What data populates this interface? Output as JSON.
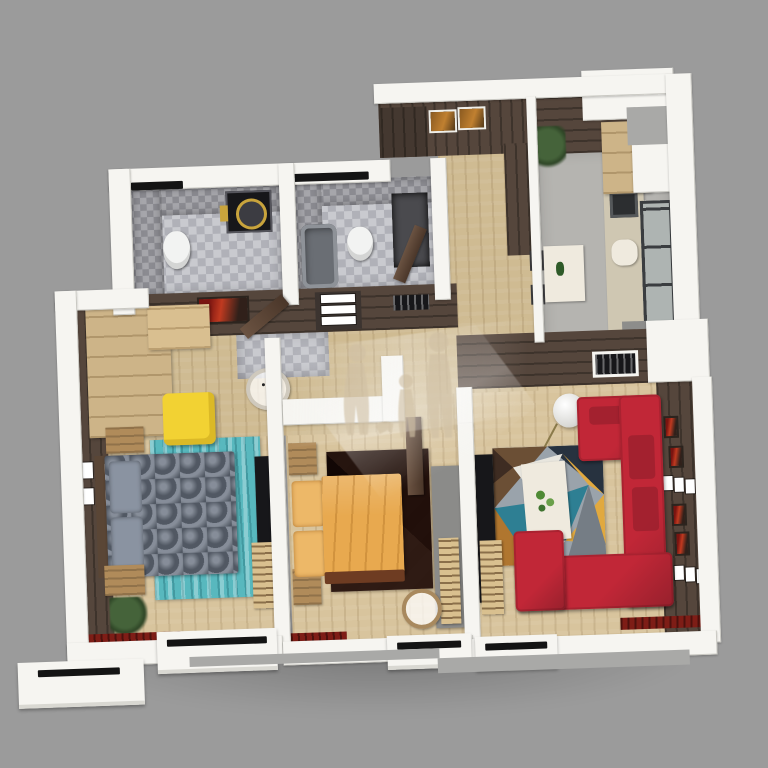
{
  "title": "3d-apartment-floor-plan-render",
  "colors": {
    "bg": "#9b9b9b",
    "wall": "#f6f5f1",
    "wallShade": "#d9d8d2",
    "wallEdge": "#c9c8c2",
    "step": "#a9a9a7",
    "brown": "#55463c",
    "woodFloor": "#d8c49d",
    "woodFloorHall": "#cfbb92",
    "tileFloorA": "#c9cacf",
    "tileFloorB": "#b0b1b8",
    "tileWallA": "#a6a6ab",
    "tileWallB": "#8b8b91",
    "kitchenFloor": "#b5b4b0",
    "counter": "#cfc7b2",
    "cabinetWood": "#cbb088",
    "wardrobeWood": "#cdb488",
    "nightstand": "#b08b5a",
    "stripeWood": "#d9c08f",
    "bedGray": "#68717f",
    "pillowGray": "#8a93a1",
    "rugTeal": "#58b8be",
    "poufYellow": "#f2d233",
    "bedOrange": "#e8a94f",
    "pillowOrange": "#edb868",
    "rugMaroon": "#4e3229",
    "sofaRed": "#c12737",
    "sofaRedDark": "#96202c",
    "tableWhite": "#efeade",
    "tvDark": "#17171a",
    "radiatorRed": "#7e1d16",
    "plantGreen": "#45633a",
    "glass": "#aeb4b2",
    "mullion": "#3a3d40",
    "toilet": "#f2f3f2",
    "gold": "#c9a43c",
    "watermarkTan": "#d0c0a4"
  },
  "rooms": [
    {
      "name": "bathroom-wc",
      "floor": "gray mosaic tile",
      "furniture": [
        "wall-hung toilet",
        "washing machine with gold door ring",
        "tiled walls"
      ]
    },
    {
      "name": "bathroom-main",
      "floor": "gray mosaic tile",
      "furniture": [
        "bathtub",
        "toilet",
        "shower panel",
        "open door"
      ]
    },
    {
      "name": "entry-hall",
      "floor": "wood",
      "furniture": [
        "two framed pictures",
        "dark wardrobe cabinets"
      ]
    },
    {
      "name": "kitchen",
      "floor": "gray stone + dark wood strip",
      "furniture": [
        "beige counter with sink",
        "upper cabinets",
        "coffee machine",
        "white dining table",
        "two chairs",
        "potted plant",
        "tall window",
        "balcony ledge"
      ]
    },
    {
      "name": "hallway",
      "floor": "wood + tile patch",
      "furniture": [
        "red wall art",
        "built-in drawers",
        "vent grille",
        "open doors"
      ]
    },
    {
      "name": "bedroom-left",
      "floor": "wood",
      "furniture": [
        "light wood wardrobe",
        "yellow pouf",
        "round clock table",
        "teal striped rug",
        "gray quilted double bed",
        "two wood nightstands",
        "plant",
        "wall tv panel",
        "striped dresser",
        "four small picture frames",
        "red radiator"
      ]
    },
    {
      "name": "bedroom-middle",
      "floor": "wood",
      "furniture": [
        "orange double bed",
        "two wood nightstands",
        "chevron maroon rug",
        "gray wardrobe with wood sliding door",
        "round wood mirror",
        "red radiator",
        "open door"
      ]
    },
    {
      "name": "living-room",
      "floor": "wood",
      "furniture": [
        "red L-shaped sectional sofa",
        "geometric multicolor rug",
        "white coffee table with green decor",
        "globe floor lamp",
        "tv panel",
        "striped media cabinet",
        "brown accent wall with six small frames",
        "vent grille",
        "dark red radiator"
      ]
    }
  ],
  "watermark": {
    "description": "faded tan silhouettes of a family (woman, child, man, dog) with white light streaks",
    "position": "center of plan"
  },
  "view": {
    "type": "3d axonometric floor plan render",
    "rotation_deg": -2,
    "background": "plain gray"
  }
}
